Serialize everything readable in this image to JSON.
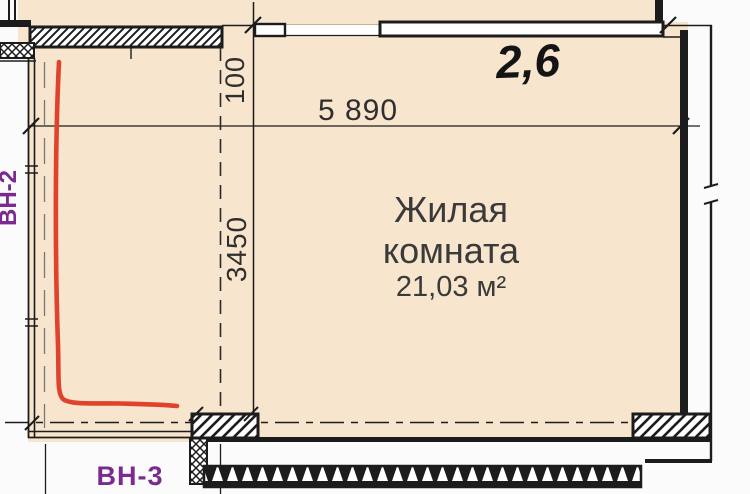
{
  "plan": {
    "room": {
      "name_line1": "Жилая",
      "name_line2": "комната",
      "area": "21,03 м²"
    },
    "dims": {
      "width": "5 890",
      "gap": "100",
      "depth": "3450"
    },
    "handwritten_note": "2,6",
    "unit_labels": {
      "left": "ВН-2",
      "bottom": "ВН-3"
    },
    "colors": {
      "room_fill": "#f8e5cd",
      "line": "#1c1c1c",
      "red": "#e0432b",
      "purple": "#7b2b8f",
      "text": "#2f2f2f",
      "bg": "#fbfbfb"
    }
  }
}
